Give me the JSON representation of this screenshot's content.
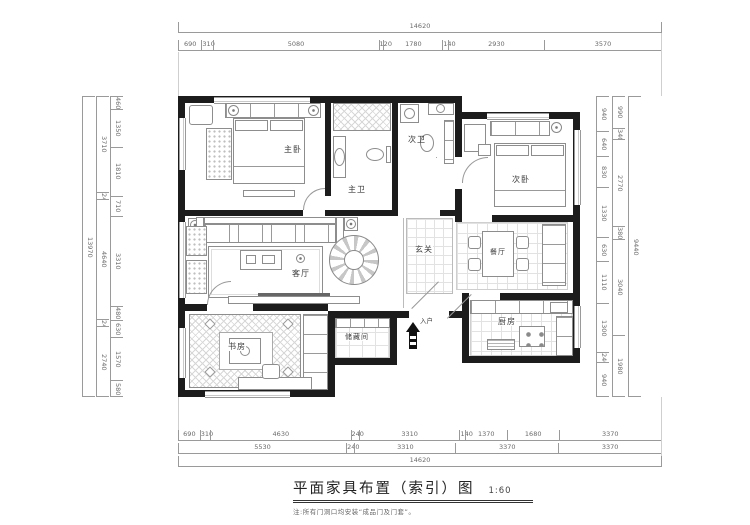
{
  "title_block": {
    "title": "平面家具布置（索引）图",
    "scale": "1:60",
    "note": "注:所有门洞口均安装“成品门及门套”。"
  },
  "rooms": {
    "master_bedroom": {
      "name": "主卧"
    },
    "master_bath": {
      "name": "主卫"
    },
    "guest_bath": {
      "name": "次卫"
    },
    "guest_bedroom": {
      "name": "次卧"
    },
    "foyer": {
      "name": "玄关"
    },
    "dining": {
      "name": "餐厅"
    },
    "kitchen": {
      "name": "厨房"
    },
    "living": {
      "name": "客厅"
    },
    "study": {
      "name": "书房"
    },
    "storage": {
      "name": "储藏间"
    },
    "entrance": {
      "name": "入户"
    }
  },
  "dimensions": {
    "top_total": [
      "14620"
    ],
    "top_segments": [
      "690",
      "310",
      "5080",
      "120",
      "1780",
      "140",
      "2930",
      "3570"
    ],
    "bottom_row1": [
      "690",
      "310",
      "4630",
      "240",
      "3310",
      "140",
      "1370",
      "1680",
      "3370"
    ],
    "bottom_row2": [
      "5530",
      "240",
      "3310",
      "3370",
      "3370"
    ],
    "bottom_total": [
      "14620"
    ],
    "left_inner": [
      "460",
      "1350",
      "1810",
      "710",
      "3310",
      "480",
      "630",
      "1570",
      "580"
    ],
    "left_mid": [
      "3710",
      "240",
      "4640",
      "240",
      "2740"
    ],
    "left_total": [
      "13970"
    ],
    "right_inner": [
      "940",
      "640",
      "830",
      "1330",
      "630",
      "1110",
      "1300",
      "240",
      "940"
    ],
    "right_mid": [
      "990",
      "340",
      "2770",
      "380",
      "3040",
      "1980"
    ],
    "right_total": [
      "9440"
    ]
  },
  "colors": {
    "wall": "#1c1c1c",
    "dim_line": "#9a9a9a",
    "label": "#3d3d3d"
  }
}
